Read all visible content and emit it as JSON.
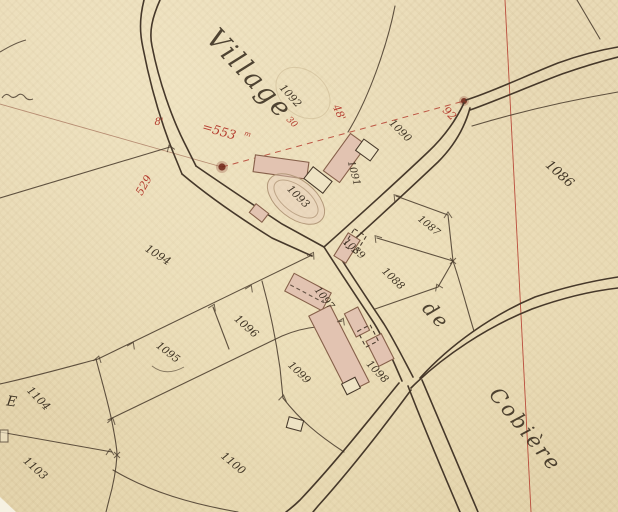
{
  "map": {
    "title_label": "Village",
    "territory": {
      "prefix": "de",
      "name": "Cobière"
    },
    "section_letter": "E"
  },
  "parcel_numbers": {
    "n1086": "1086",
    "n1087": "1087",
    "n1088": "1088",
    "n1089": "1089",
    "n1090": "1090",
    "n1091": "1091",
    "n1092": "1092",
    "n1093": "1093",
    "n1094": "1094",
    "n1095": "1095",
    "n1096": "1096",
    "n1097": "1097",
    "n1098": "1098",
    "n1099": "1099",
    "n1100": "1100",
    "n1103": "1103",
    "n1104": "1104"
  },
  "measurements": {
    "m553": "=553",
    "m553_sup": "m",
    "m8": "8'",
    "m529": "529",
    "m48": "48'",
    "m92": "92",
    "m30": "30"
  },
  "colors": {
    "paper": "#e8d8b2",
    "paper_light": "#eee3c4",
    "ink": "#46382a",
    "label_ink": "#33281a",
    "red": "#b23528",
    "red_faded": "#a06a52",
    "building": "#e2c3b1",
    "building_stroke": "#86604a"
  }
}
